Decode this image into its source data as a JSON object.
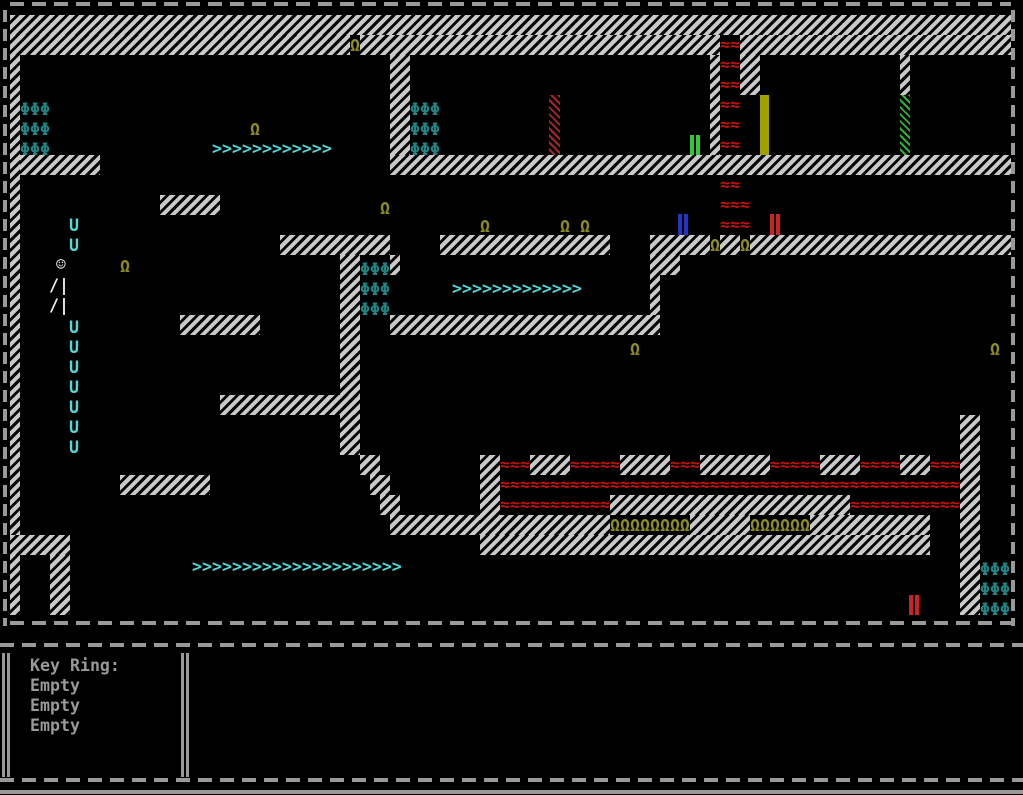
{
  "hud": {
    "title": "Key Ring:",
    "slots": [
      "Empty",
      "Empty",
      "Empty"
    ]
  },
  "colors": {
    "wall_light": "#c9c9c9",
    "lava_red": "#cc1111",
    "omega_olive": "#8b8b21",
    "phi_teal": "#1f8585",
    "arrow_cyan": "#4fd9d9",
    "door_yellow": "#a0a000",
    "door_green_bars": "#2ecc2e",
    "door_blue_bars": "#2233cc",
    "door_red_bars": "#cc2222",
    "door_hatch_red": "#aa2525",
    "door_hatch_green": "#2db22d",
    "player_white": "#eeeeee",
    "hud_text": "#999999",
    "border_gray": "#999999"
  },
  "glyphs": {
    "phi": "Φ",
    "omega": "Ω",
    "lava": "≈",
    "arrow_right": ">",
    "arrow_down": "U"
  },
  "map": {
    "walls": [
      [
        10,
        15,
        1001,
        20
      ],
      [
        10,
        35,
        340,
        20
      ],
      [
        360,
        35,
        360,
        20
      ],
      [
        740,
        35,
        271,
        20
      ],
      [
        10,
        55,
        10,
        480
      ],
      [
        20,
        155,
        80,
        20
      ],
      [
        390,
        55,
        20,
        120
      ],
      [
        390,
        155,
        621,
        20
      ],
      [
        160,
        195,
        60,
        20
      ],
      [
        710,
        55,
        10,
        100
      ],
      [
        740,
        55,
        20,
        40
      ],
      [
        900,
        55,
        10,
        40
      ],
      [
        280,
        235,
        110,
        20
      ],
      [
        340,
        255,
        20,
        200
      ],
      [
        390,
        255,
        10,
        20
      ],
      [
        440,
        235,
        170,
        20
      ],
      [
        650,
        235,
        60,
        20
      ],
      [
        650,
        255,
        10,
        60
      ],
      [
        660,
        255,
        20,
        20
      ],
      [
        720,
        235,
        20,
        20
      ],
      [
        750,
        235,
        261,
        20
      ],
      [
        180,
        315,
        80,
        20
      ],
      [
        390,
        315,
        270,
        20
      ],
      [
        220,
        395,
        140,
        20
      ],
      [
        120,
        475,
        90,
        20
      ],
      [
        360,
        455,
        20,
        20
      ],
      [
        370,
        475,
        20,
        20
      ],
      [
        380,
        495,
        20,
        20
      ],
      [
        390,
        515,
        220,
        20
      ],
      [
        690,
        515,
        60,
        20
      ],
      [
        810,
        515,
        120,
        20
      ],
      [
        480,
        455,
        20,
        100
      ],
      [
        480,
        535,
        450,
        20
      ],
      [
        610,
        495,
        240,
        20
      ],
      [
        960,
        415,
        20,
        200
      ],
      [
        530,
        455,
        40,
        20
      ],
      [
        620,
        455,
        50,
        20
      ],
      [
        700,
        455,
        70,
        20
      ],
      [
        820,
        455,
        40,
        20
      ],
      [
        900,
        455,
        30,
        20
      ],
      [
        10,
        535,
        60,
        20
      ],
      [
        10,
        555,
        10,
        60
      ],
      [
        50,
        555,
        20,
        60
      ]
    ],
    "lava_blocks": [
      [
        720,
        35,
        20,
        20
      ],
      [
        720,
        55,
        20,
        100
      ],
      [
        720,
        175,
        20,
        20
      ],
      [
        720,
        195,
        30,
        40
      ],
      [
        500,
        455,
        30,
        20
      ],
      [
        570,
        455,
        50,
        20
      ],
      [
        670,
        455,
        30,
        20
      ],
      [
        770,
        455,
        50,
        20
      ],
      [
        860,
        455,
        40,
        20
      ],
      [
        930,
        455,
        30,
        20
      ],
      [
        500,
        475,
        460,
        20
      ],
      [
        500,
        495,
        110,
        20
      ],
      [
        850,
        495,
        110,
        20
      ]
    ],
    "phi_groups": [
      {
        "x": 20,
        "y": 100,
        "cols": 3,
        "rows": 3
      },
      {
        "x": 410,
        "y": 100,
        "cols": 3,
        "rows": 3
      },
      {
        "x": 360,
        "y": 260,
        "cols": 3,
        "rows": 3
      },
      {
        "x": 980,
        "y": 560,
        "cols": 3,
        "rows": 3
      }
    ],
    "omegas": [
      [
        350,
        36
      ],
      [
        250,
        120
      ],
      [
        380,
        199
      ],
      [
        480,
        217
      ],
      [
        560,
        217
      ],
      [
        580,
        217
      ],
      [
        120,
        257
      ],
      [
        710,
        236
      ],
      [
        740,
        236
      ],
      [
        630,
        340
      ],
      [
        990,
        340
      ]
    ],
    "omega_rows": [
      {
        "x": 610,
        "y": 516,
        "count": 8
      },
      {
        "x": 750,
        "y": 516,
        "count": 6
      }
    ],
    "arrow_rows": [
      {
        "x": 212,
        "y": 139,
        "count": 12
      },
      {
        "x": 452,
        "y": 279,
        "count": 13
      },
      {
        "x": 192,
        "y": 557,
        "count": 21
      }
    ],
    "down_arrows": {
      "x": 69,
      "ys": [
        216,
        236,
        318,
        338,
        358,
        378,
        398,
        418,
        438
      ]
    },
    "player": {
      "parts": [
        {
          "ch": "☺",
          "x": 56,
          "y": 255
        },
        {
          "ch": "/|",
          "x": 49,
          "y": 276
        },
        {
          "ch": "/|",
          "x": 49,
          "y": 296
        }
      ]
    },
    "doors": [
      {
        "type": "hatch-red",
        "x": 549,
        "y": 95,
        "w": 11,
        "h": 60
      },
      {
        "type": "solid-yellow",
        "x": 760,
        "y": 95,
        "w": 9,
        "h": 60
      },
      {
        "type": "hatch-green",
        "x": 900,
        "y": 95,
        "w": 10,
        "h": 60
      },
      {
        "type": "bars-green",
        "x": 690,
        "y": 135,
        "w": 10,
        "h": 20
      },
      {
        "type": "bars-blue",
        "x": 678,
        "y": 214,
        "w": 12,
        "h": 21
      },
      {
        "type": "bars-red",
        "x": 770,
        "y": 214,
        "w": 11,
        "h": 21
      },
      {
        "type": "bars-red",
        "x": 909,
        "y": 595,
        "w": 11,
        "h": 20
      }
    ]
  }
}
